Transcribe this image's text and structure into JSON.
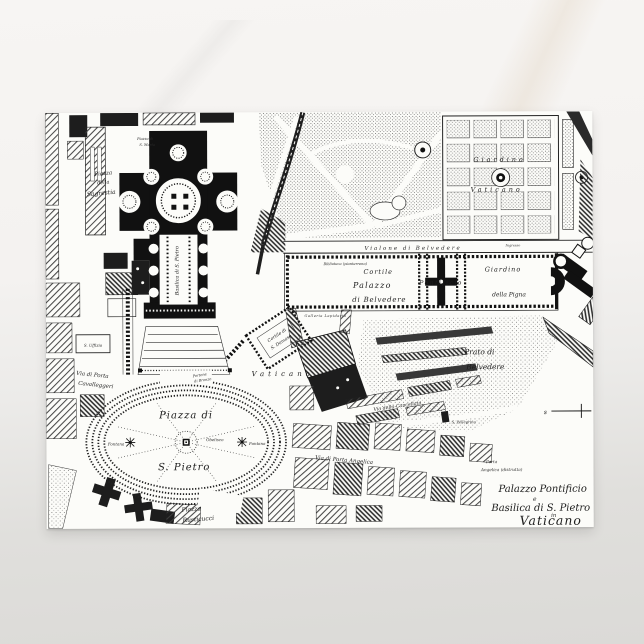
{
  "scene": {
    "background_name": "marble-surface"
  },
  "postcard": {
    "kind": "vintage engraved map postcard",
    "colors": {
      "ink": "#1c1c1c",
      "paper": "#fcfcf9"
    },
    "map_title": {
      "line1": "Palazzo Pontificio",
      "line2": "e",
      "line3": "Basilica di S. Pietro",
      "line4": "in",
      "line5": "Vaticano"
    },
    "labels": {
      "piazza_sagrestia_1": "Piazza",
      "piazza_sagrestia_2": "della",
      "piazza_sagrestia_3": "Sagrestia",
      "s_marta_1": "Piazza di",
      "s_marta_2": "S. Marta",
      "basilica_axis": "Basilica di S. Pietro",
      "piazza_spietro_1": "Piazza di",
      "piazza_spietro_2": "S. Pietro",
      "obelisco": "Obelisco",
      "fontana_left": "Fontana",
      "fontana_right": "Fontana",
      "portone_bronzo_1": "Portone",
      "portone_bronzo_2": "di Bronzo",
      "via_cavalleggeri_1": "Via di Porta",
      "via_cavalleggeri_2": "Cavalleggeri",
      "s_uffizio": "S. Uffizio",
      "piazza_rusticucci_1": "Piazza",
      "piazza_rusticucci_2": "Rusticucci",
      "vialone": "Vialone di Belvedere",
      "biblioteca": "Biblioteca (pianterreno)",
      "cortile": "Cortile",
      "palazzo": "Palazzo",
      "di_belvedere": "di Belvedere",
      "galleria_lapidaria": "Galleria Lapidaria",
      "pontificio": "Pontificio",
      "giardino_pigna_1": "Giardino",
      "giardino_pigna_2": "della Pigna",
      "ingresso": "Ingresso",
      "giardino_vaticano_1": "Giardino",
      "giardino_vaticano_2": "Vaticano",
      "prato_1": "Prato di",
      "prato_2": "Belvedere",
      "cortile_damaso_1": "Cortile di",
      "cortile_damaso_2": "S. Damaso",
      "vaticano_palazzo": "Vaticano",
      "via_cancellata": "Via della Cancellata",
      "s_pellegrino": "S. Pellegrino",
      "via_porta_angelica": "Via di Porta Angelica",
      "porta_angelica_1": "Porta",
      "porta_angelica_2": "Angelica (distrutta)",
      "scale_letter": "s"
    }
  }
}
